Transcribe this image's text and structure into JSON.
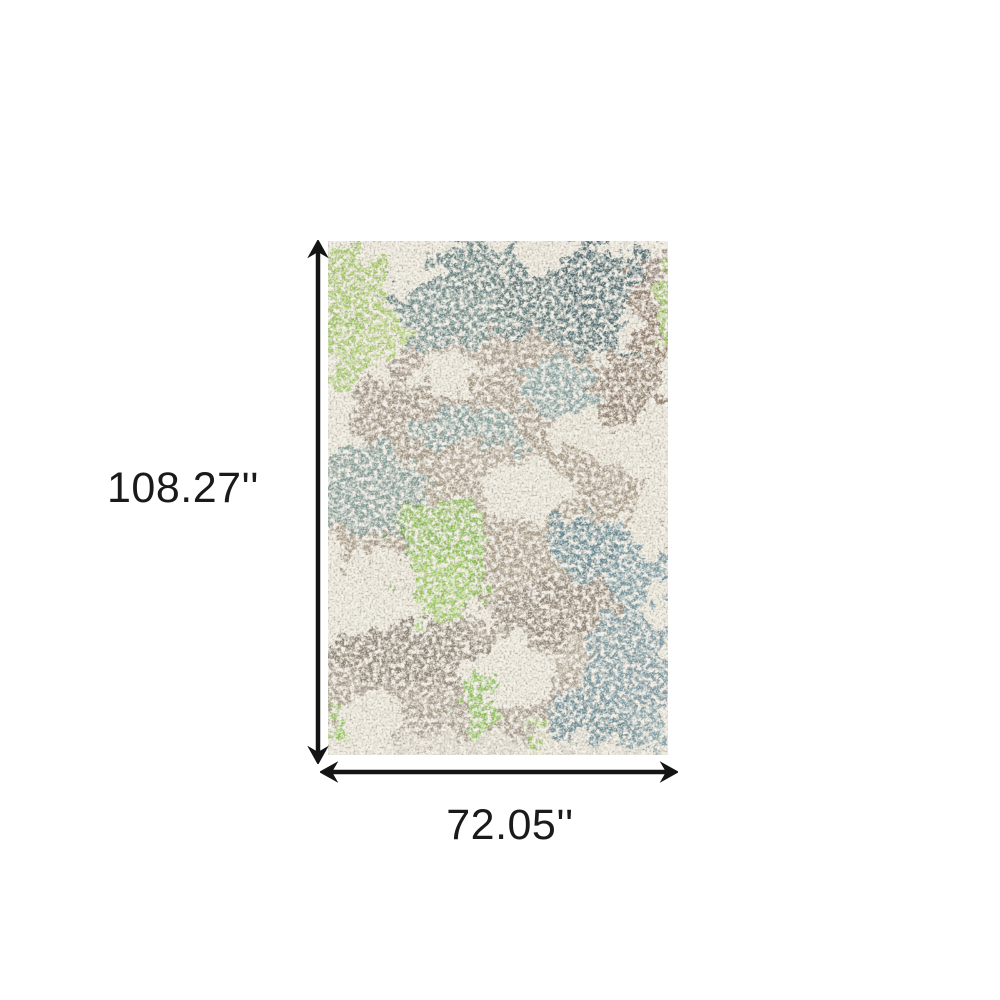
{
  "page": {
    "background_color": "#ffffff"
  },
  "diagram": {
    "name": "rug-dimension-diagram",
    "height_label": "108.27''",
    "width_label": "72.05''",
    "arrow_color": "#141414",
    "label_color": "#1a1a1a",
    "rug": {
      "description": "Abstract distressed area rug in lime green, slate teal, taupe and ivory",
      "colors": {
        "ivory_base": "#ebe7d9",
        "slate_teal": "#5d7b7c",
        "dark_teal": "#4c6a6f",
        "muted_teal": "#7f9a96",
        "blue_teal": "#6f94a0",
        "lime_green": "#a6c966",
        "bright_green": "#8cbf55",
        "taupe": "#a39584",
        "grey_brown": "#8a7f6f",
        "brown": "#8a7464"
      }
    }
  }
}
